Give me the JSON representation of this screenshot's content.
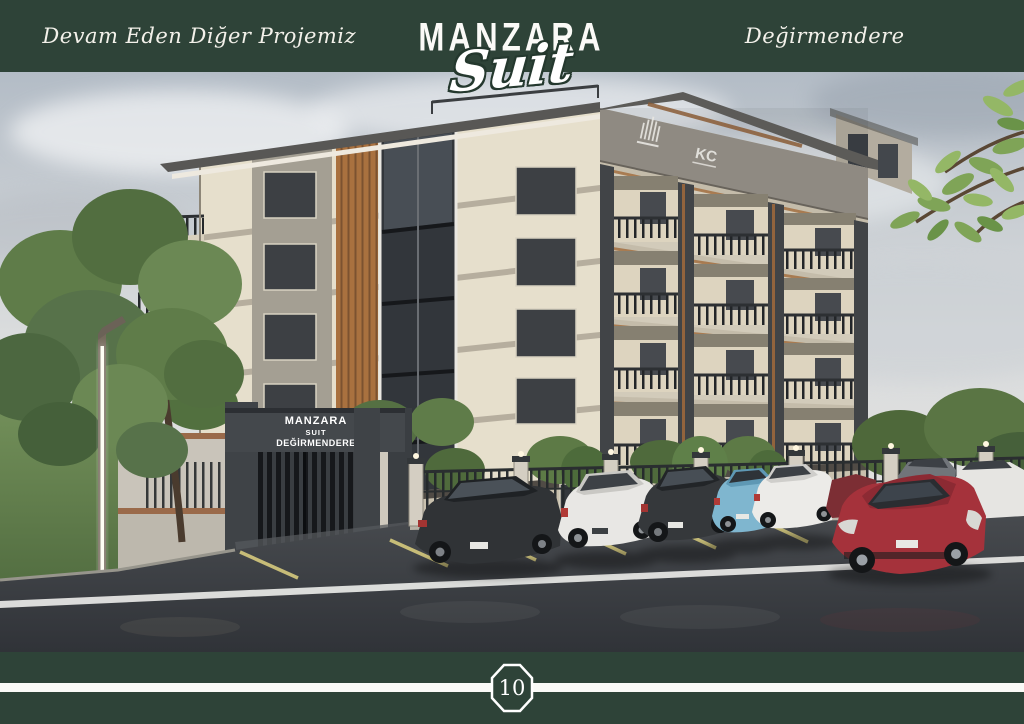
{
  "header": {
    "left_text": "Devam Eden Diğer Projemiz",
    "project_name": "MANZARA",
    "project_script": "Suit",
    "location": "Değirmendere"
  },
  "scene": {
    "gate_sign": {
      "line1": "MANZARA",
      "line2": "SUIT",
      "line3": "DEĞİRMENDERE"
    },
    "facade_logo_kc": "KC"
  },
  "footer": {
    "page_number": "10"
  },
  "colors": {
    "band_green": "#2e4338",
    "text_cream": "#f3f1ea",
    "facade_cream": "#e6dfcc",
    "facade_gray": "#98938a",
    "wood_accent": "#a9713f",
    "frame_dark": "#44474b",
    "glass_dark": "#32363b",
    "asphalt": "#3b3e42",
    "grass_green": "#5e7a45",
    "sky_gray": "#c3c9cf",
    "car_red": "#a5323b",
    "car_blue": "#7fb6cf",
    "parking_line_yellow": "#d6ca7e",
    "road_line_white": "#e9e9e7"
  }
}
